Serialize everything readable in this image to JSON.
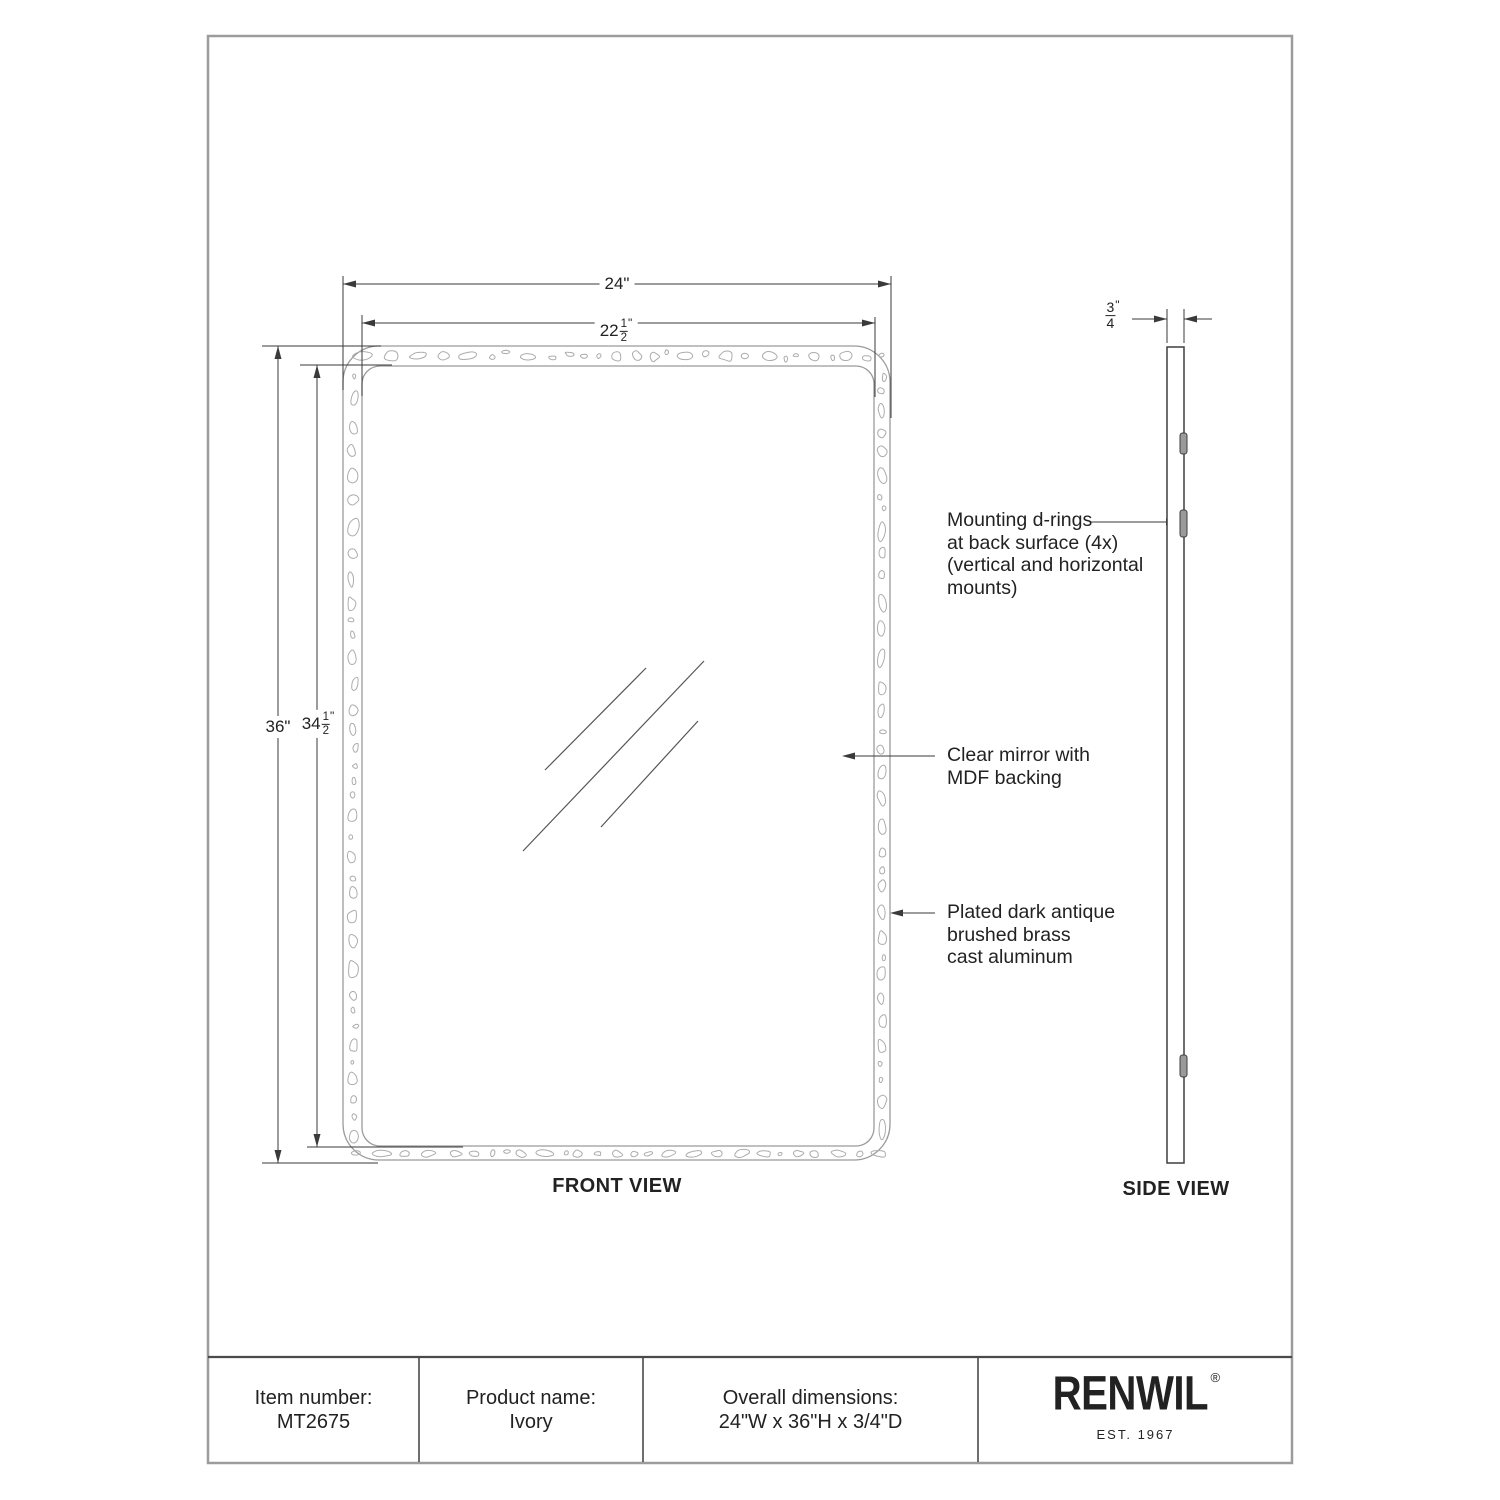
{
  "front_view": {
    "label": "FRONT VIEW",
    "dim_width_outer": "24\"",
    "dim_width_inner": {
      "whole": "22",
      "num": "1",
      "den": "2",
      "unit": "\""
    },
    "dim_height_outer": "36\"",
    "dim_height_inner": {
      "whole": "34",
      "num": "1",
      "den": "2",
      "unit": "\""
    }
  },
  "side_view": {
    "label": "SIDE VIEW",
    "dim_depth": {
      "whole": "",
      "num": "3",
      "den": "4",
      "unit": "\""
    }
  },
  "annotations": {
    "mounting": {
      "lines": [
        "Mounting d-rings",
        "at back surface (4x)",
        "(vertical and horizontal",
        "mounts)"
      ]
    },
    "mirror": {
      "lines": [
        "Clear mirror with",
        "MDF backing"
      ]
    },
    "frame": {
      "lines": [
        "Plated dark antique",
        "brushed brass",
        "cast aluminum"
      ]
    }
  },
  "title_block": {
    "item_number_label": "Item number:",
    "item_number_value": "MT2675",
    "product_name_label": "Product name:",
    "product_name_value": "Ivory",
    "dimensions_label": "Overall dimensions:",
    "dimensions_value": "24\"W x 36\"H x 3/4\"D",
    "brand": {
      "name": "RENWIL",
      "registered": "®",
      "est": "EST. 1967"
    }
  },
  "colors": {
    "ink": "#222222",
    "dim": "#3a3a3a",
    "frame": "#9b9b9b",
    "texture": "#acacac",
    "glass": "#555555",
    "bar": "#3f3f3f",
    "dringfill": "#9a9a9a",
    "tableline": "#4a4a4a",
    "sheet": "#9c9c9c"
  }
}
